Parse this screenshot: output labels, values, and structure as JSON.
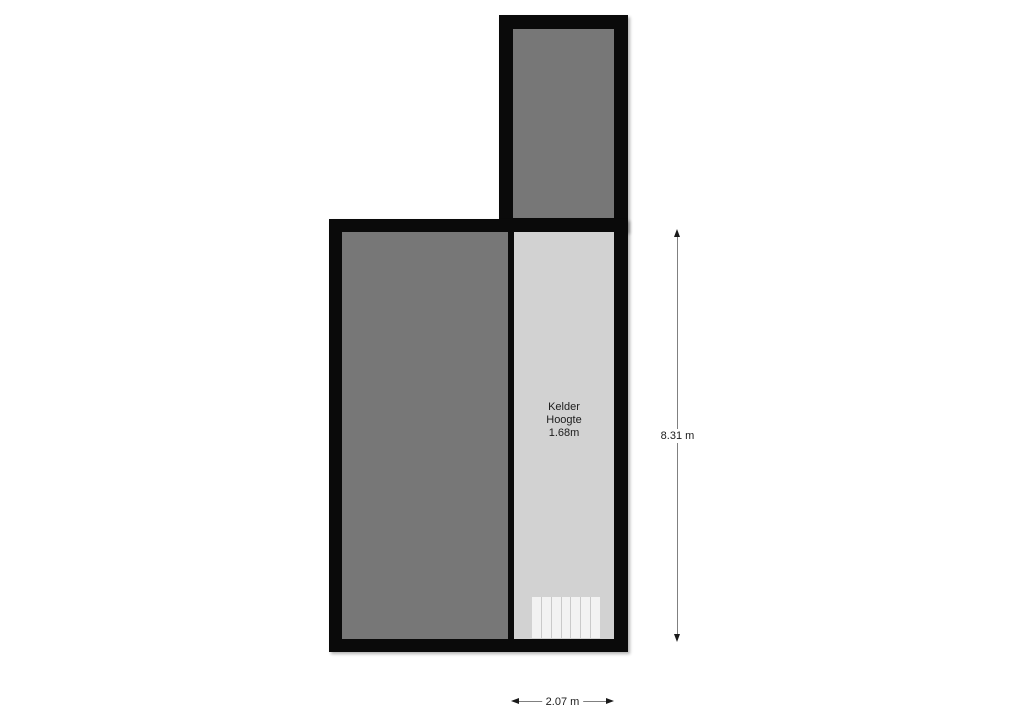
{
  "floorplan": {
    "rooms": {
      "kelder": {
        "name": "Kelder",
        "attr_label": "Hoogte",
        "attr_value": "1.68m"
      }
    },
    "dimensions": {
      "vertical": "8.31 m",
      "horizontal": "2.07 m"
    },
    "stairs": {
      "treads": 7
    },
    "colors": {
      "wall": "#0a0a0a",
      "room_dark": "#777777",
      "room_light": "#d2d2d2",
      "stair_tread": "#f2f2f2",
      "stair_line": "#c9c9c9",
      "dim_line": "#808080",
      "arrow": "#1a1a1a",
      "text": "#1c1c1c",
      "background": "#ffffff"
    }
  }
}
